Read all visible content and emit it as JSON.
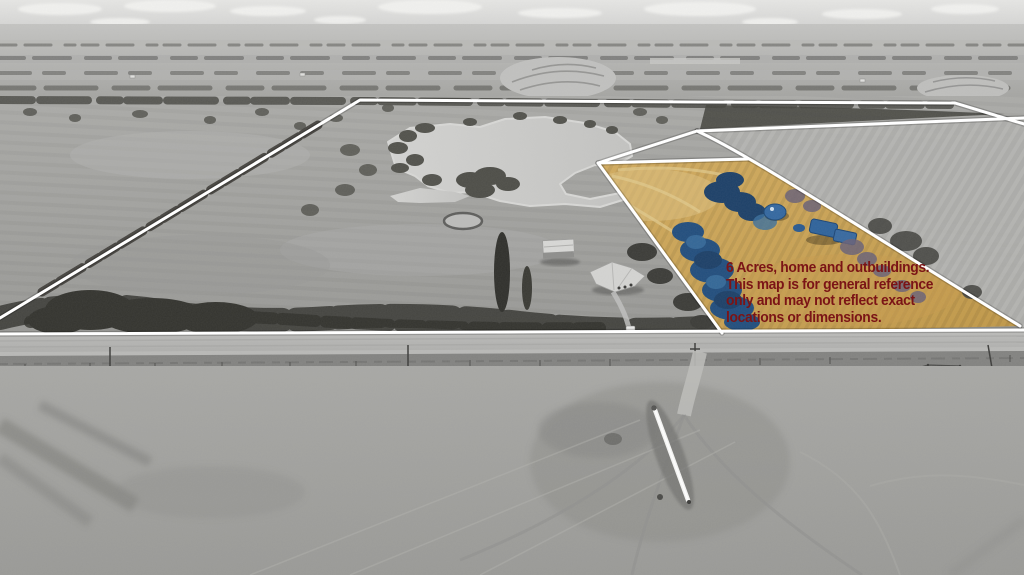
{
  "annotation": {
    "line1": "6 Acres, home and outbuildings.",
    "line2": "This map is for general reference",
    "line3": "only and may not reflect exact",
    "line4": "locations or dimensions."
  },
  "colors": {
    "annotation_text": "#7b1416",
    "boundary_line": "#ffffff",
    "parcel_highlight_grass": "#cba65c",
    "parcel_roof_blue": "#31659a"
  }
}
